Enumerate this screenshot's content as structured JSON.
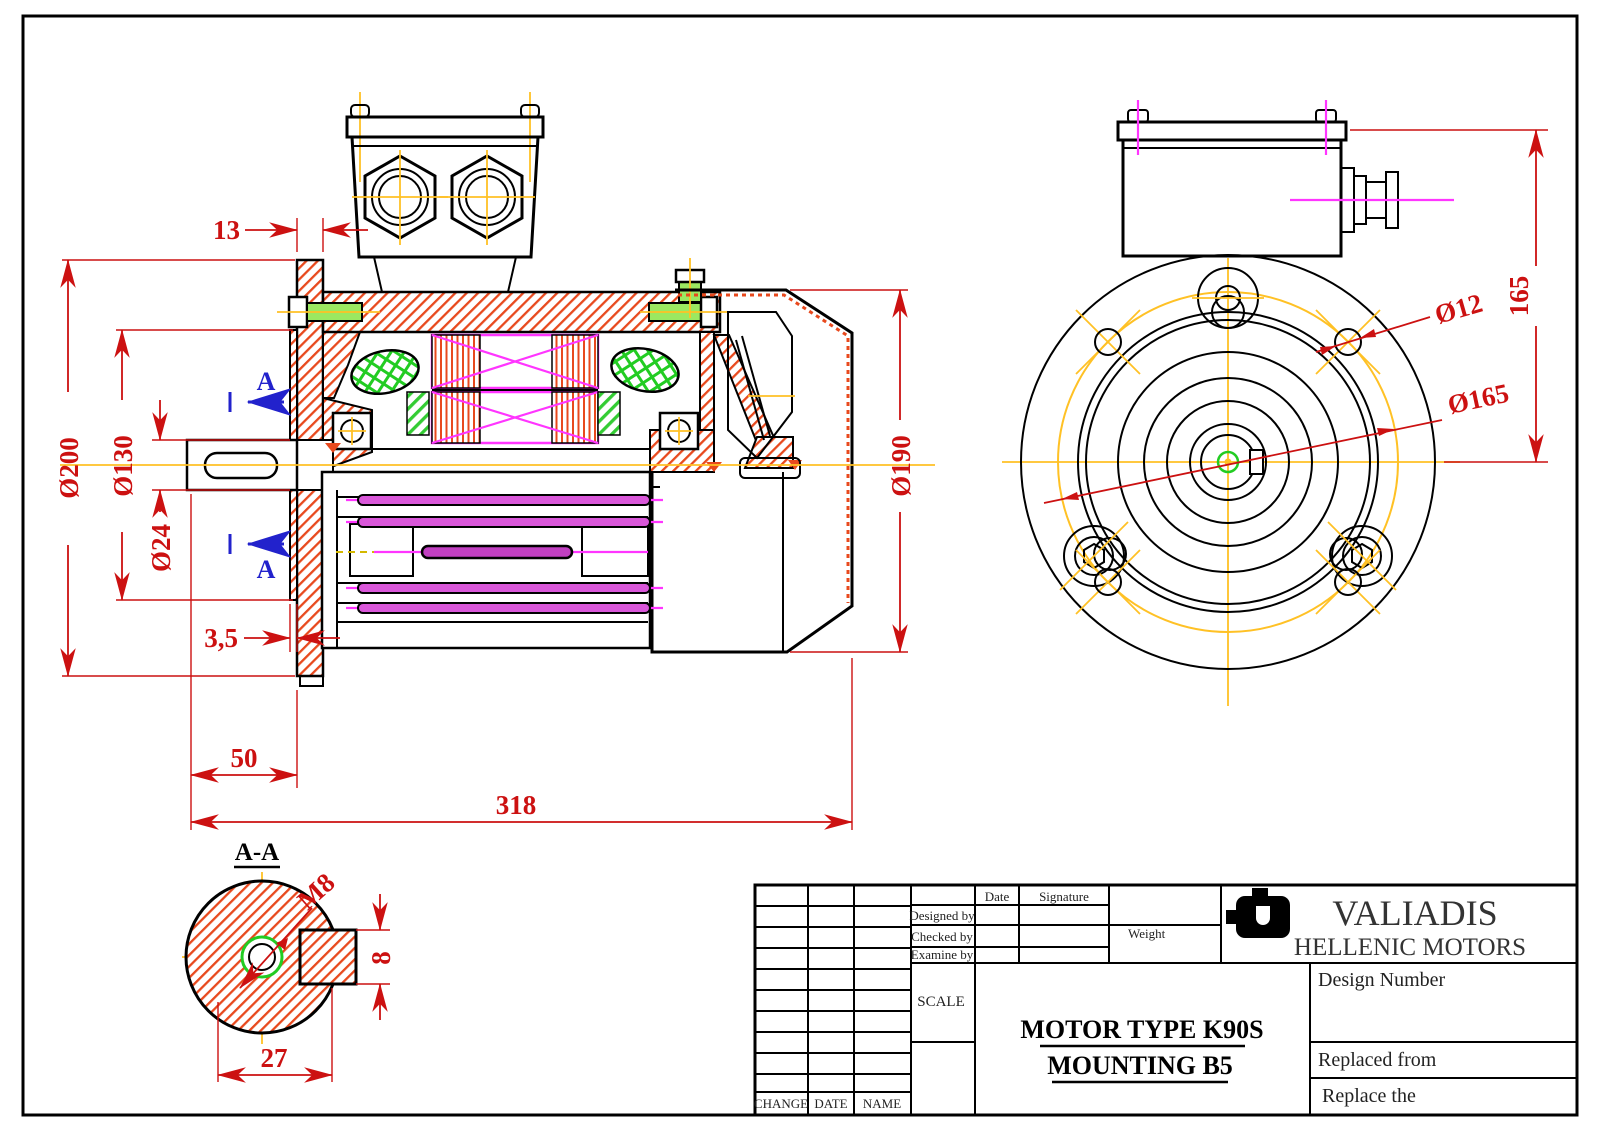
{
  "drawing": {
    "section_marker": "A",
    "dims": {
      "flange_offset": "13",
      "outer_diameter": "Ø200",
      "spigot_diameter": "Ø130",
      "shaft_diameter": "Ø24",
      "spigot_depth": "3,5",
      "shaft_length": "50",
      "total_length": "318",
      "body_diameter": "Ø190",
      "box_height": "165",
      "bolt_hole": "Ø12",
      "bolt_circle": "Ø165"
    },
    "section": {
      "title": "A-A",
      "thread": "M8",
      "key_width": "8",
      "section_width": "27"
    }
  },
  "title_block": {
    "brand": {
      "name": "VALIADIS",
      "subtitle": "HELLENIC MOTORS"
    },
    "approval": {
      "date": "Date",
      "signature": "Signature",
      "designed_by": "Designed by",
      "checked_by": "Checked by",
      "examine_by": "Examine by",
      "weight": "Weight",
      "scale": "SCALE"
    },
    "product": {
      "line1": "MOTOR TYPE K90S",
      "line2": "MOUNTING  B5"
    },
    "refs": {
      "design_number": "Design Number",
      "replaced_from": "Replaced from",
      "replace_the": "Replace the"
    },
    "revision_footer": {
      "change": "CHANGE",
      "date": "DATE",
      "name": "NAME"
    }
  },
  "colors": {
    "dimension": "#CC1111",
    "centerline": "#FFC125",
    "hatch": "#E8491D",
    "winding": "#FF35FF",
    "insulation": "#22CC22",
    "section_marker": "#2222CC",
    "tie_rod": "#C94FC9"
  }
}
